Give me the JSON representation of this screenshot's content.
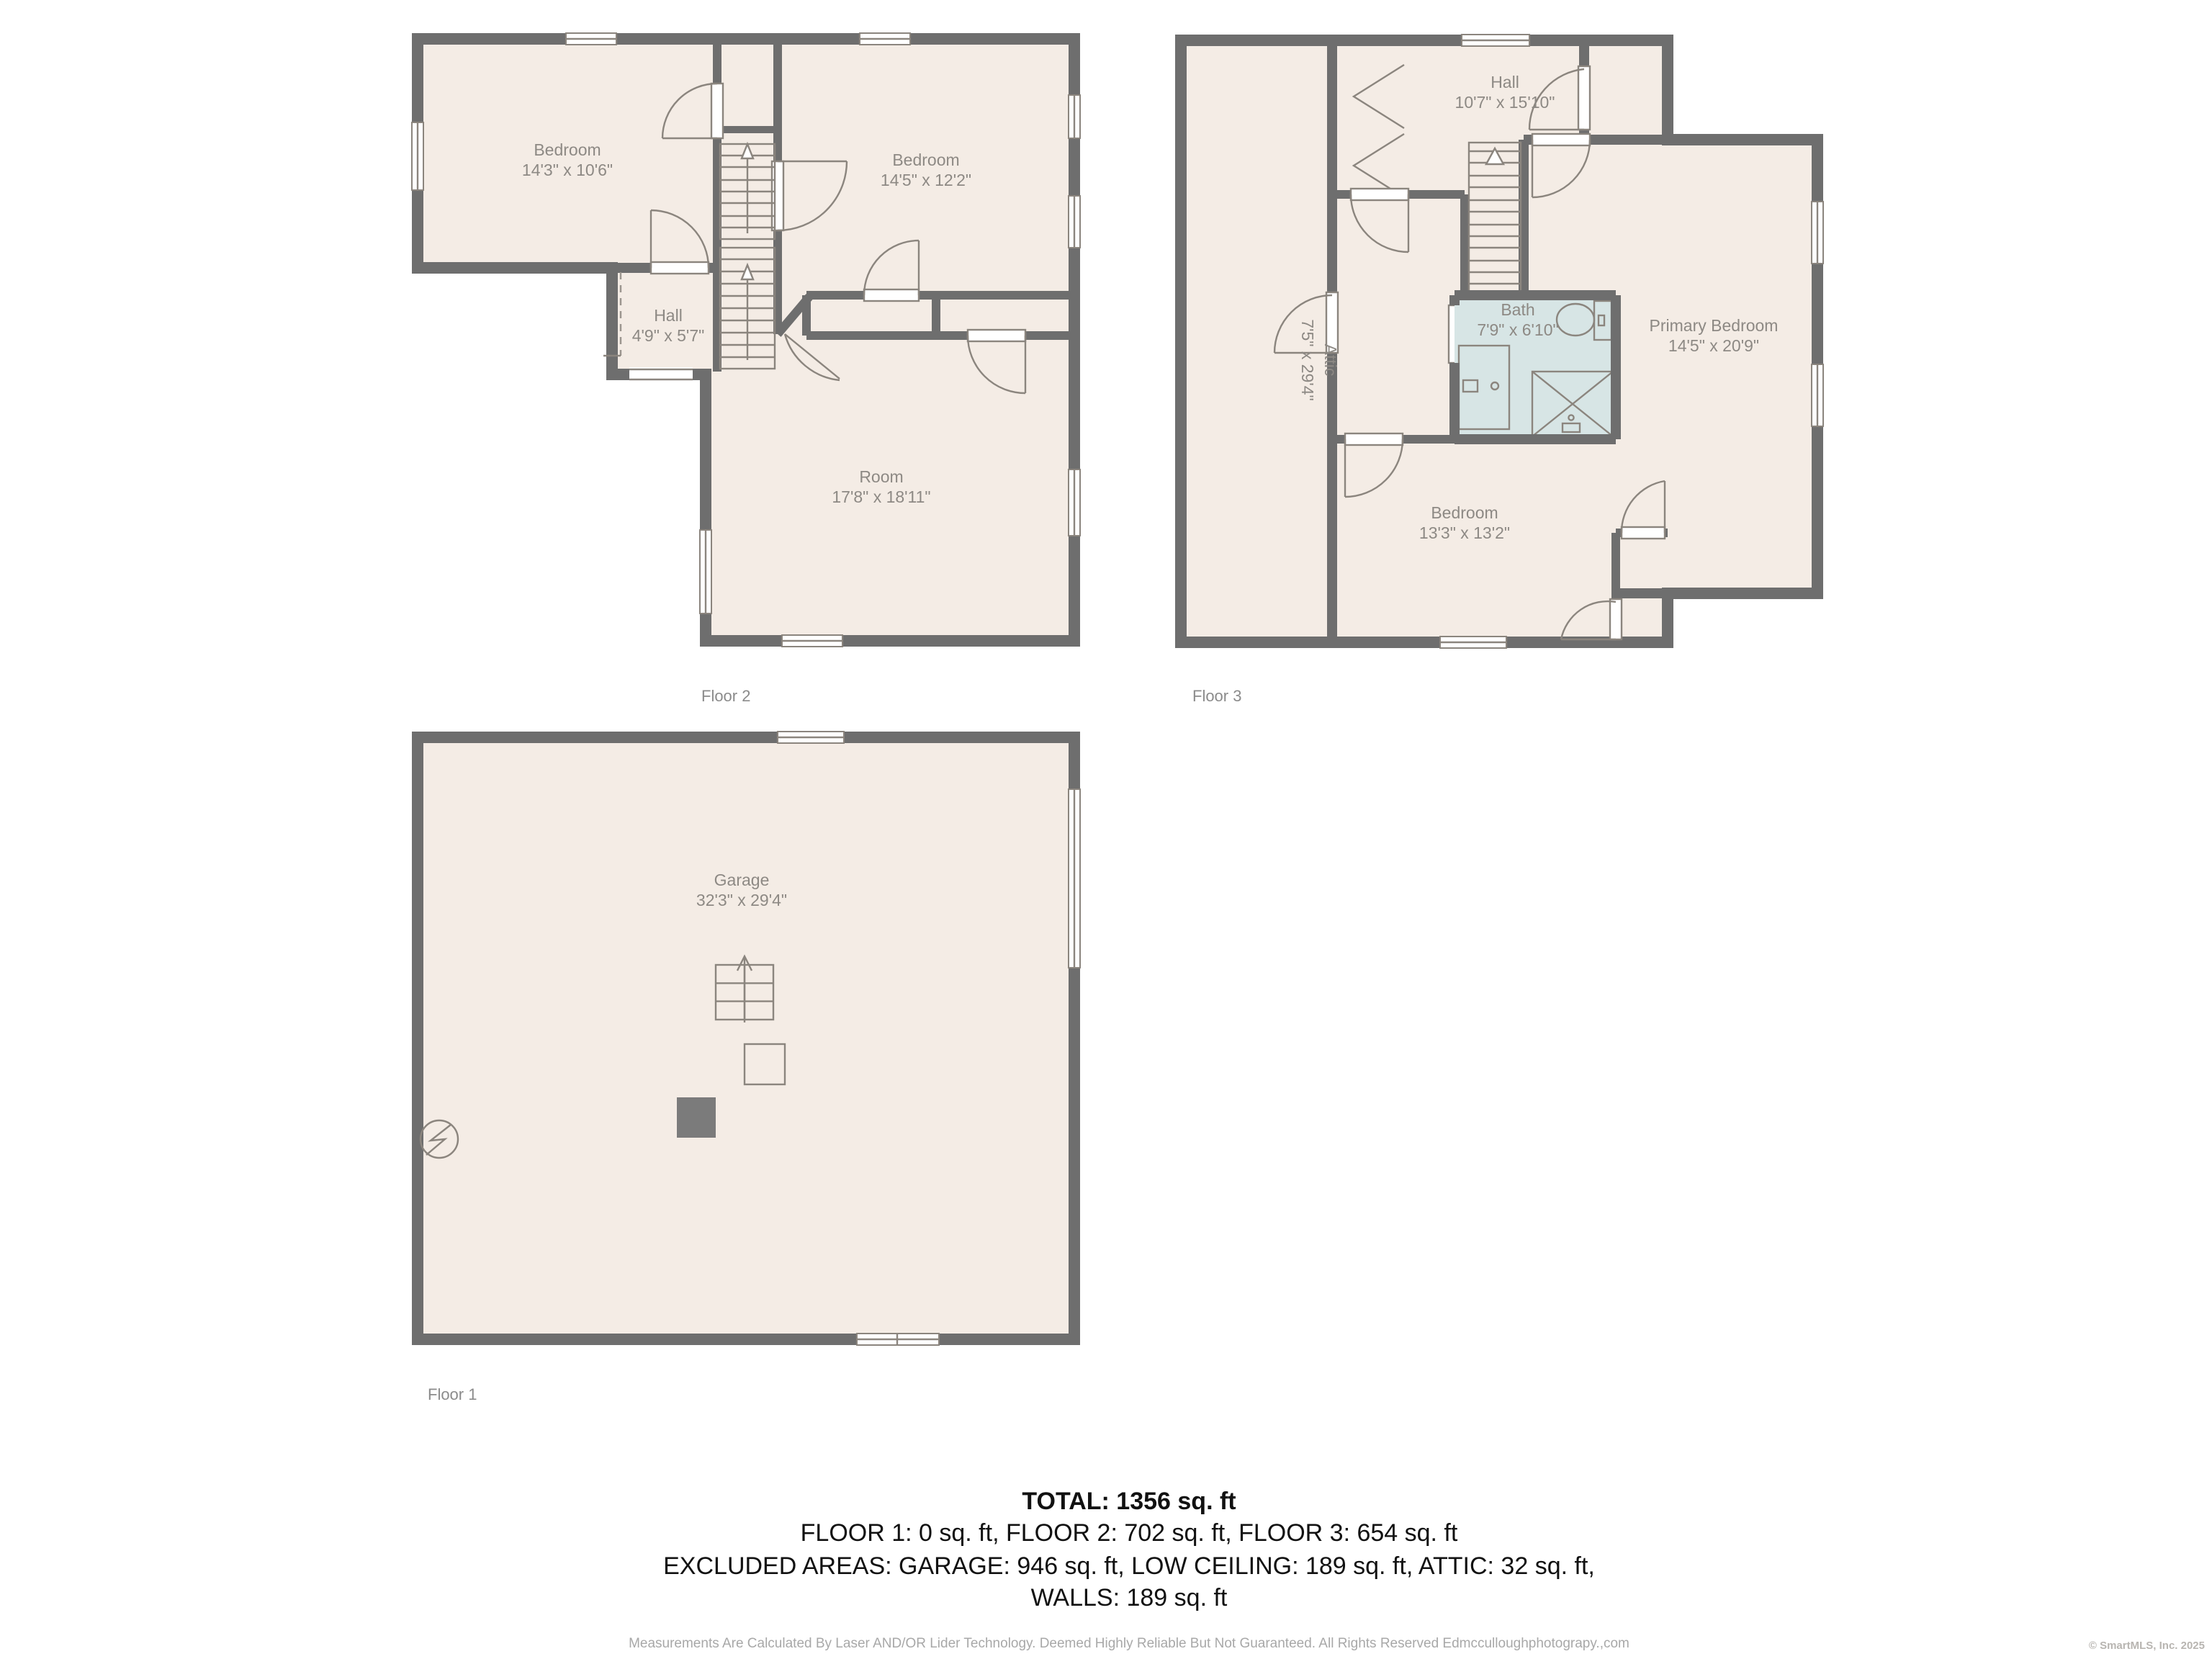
{
  "colors": {
    "wall": "#6e6e6e",
    "floor_fill": "#f4ece5",
    "bath_fill": "#d7e5e5",
    "label_text": "#8d8984",
    "summary_text": "#111111"
  },
  "floors": {
    "floor2": {
      "caption": "Floor 2",
      "rooms": {
        "bedroom1": {
          "name": "Bedroom",
          "dims": "14'3\" x 10'6\""
        },
        "bedroom2": {
          "name": "Bedroom",
          "dims": "14'5\" x 12'2\""
        },
        "hall": {
          "name": "Hall",
          "dims": "4'9\" x 5'7\""
        },
        "room": {
          "name": "Room",
          "dims": "17'8\" x 18'11\""
        }
      }
    },
    "floor3": {
      "caption": "Floor 3",
      "rooms": {
        "hall": {
          "name": "Hall",
          "dims": "10'7\" x 15'10\""
        },
        "attic": {
          "name": "Attic",
          "dims": "7'5\" x 29'4\""
        },
        "bath": {
          "name": "Bath",
          "dims": "7'9\" x 6'10\""
        },
        "primary": {
          "name": "Primary Bedroom",
          "dims": "14'5\" x 20'9\""
        },
        "bedroom": {
          "name": "Bedroom",
          "dims": "13'3\" x 13'2\""
        }
      }
    },
    "floor1": {
      "caption": "Floor 1",
      "rooms": {
        "garage": {
          "name": "Garage",
          "dims": "32'3\" x 29'4\""
        }
      }
    }
  },
  "summary": {
    "total": "TOTAL: 1356 sq. ft",
    "line2": "FLOOR 1: 0 sq. ft, FLOOR 2: 702 sq. ft, FLOOR 3: 654 sq. ft",
    "line3": "EXCLUDED AREAS: GARAGE: 946 sq. ft, LOW CEILING: 189 sq. ft, ATTIC: 32 sq. ft,",
    "line4": "WALLS: 189 sq. ft"
  },
  "footer": {
    "disclaimer": "Measurements Are Calculated By Laser AND/OR Lider Technology. Deemed Highly Reliable But Not Guaranteed. All Rights Reserved Edmcculloughphotograpy.,com",
    "copyright": "© SmartMLS, Inc. 2025"
  }
}
